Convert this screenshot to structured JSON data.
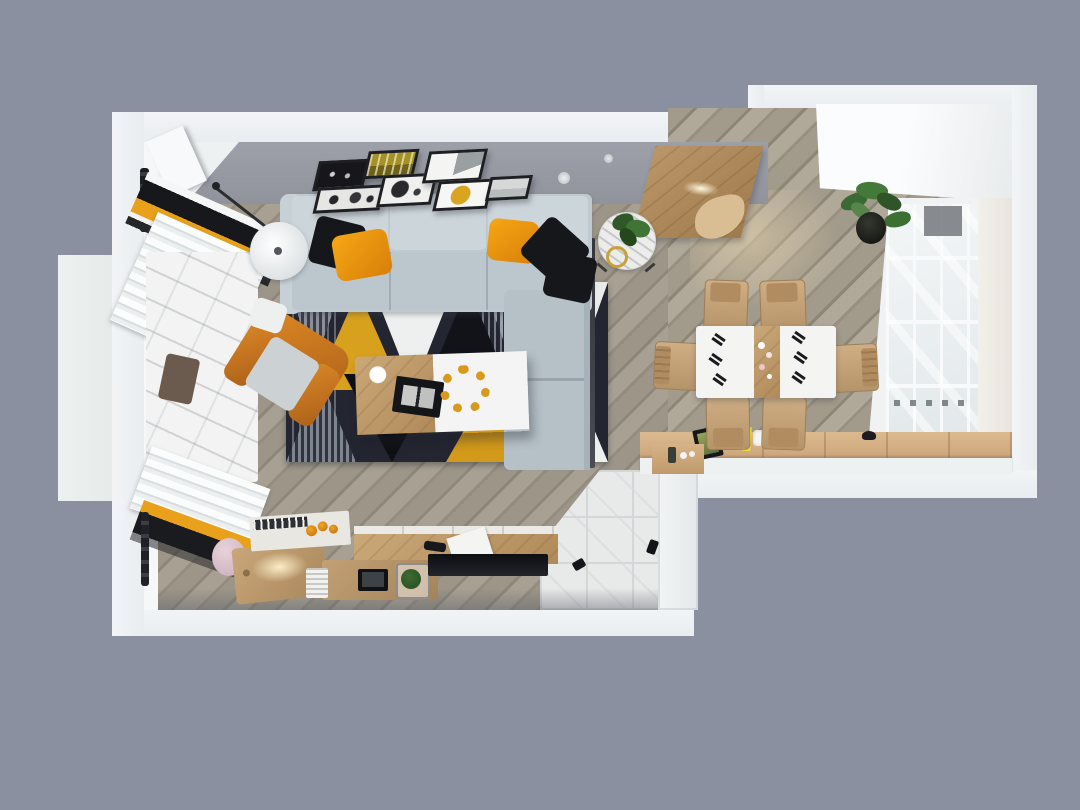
{
  "scene": {
    "type": "3d-floor-plan-top-view",
    "description": "Photorealistic top-down 3D render of a studio apartment: living room with L-shaped sofa and geometric rug, bedroom nook with curtains on the left, dining area with six chairs, kitchen corner with sink island, large gridded window on the right wall, gallery wall frames on the top wall.",
    "visible_text": "none"
  },
  "palette": {
    "bg": "#8a90a0",
    "wall": "#f2f4f6",
    "bump": "#e6ebe9",
    "ceiling-a": "#9da0a9",
    "ceiling-b": "#90939c",
    "floor-a": "#9d9688",
    "floor-b": "#8e8779",
    "floor-c": "#a8a193",
    "floor-d": "#948d7f",
    "tile": "#e8e9e9",
    "tile-line": "#d4d7d8",
    "rug": "#232530",
    "rug-yellow": "#d7a01d",
    "rug-white": "#eef0ef",
    "rug-gray": "#868b96",
    "sofa": "#bfc9d0",
    "sofa-light": "#ccd5da",
    "chaise": "#b6c0c7",
    "orange": "#ef9b10",
    "orange-dark": "#c97a17",
    "armchair": "#cd7a20",
    "wood": "#b18a5a",
    "wood-light": "#caa878",
    "tan": "#cfae84",
    "tan-dark": "#b6946a",
    "white": "#f4f5f4",
    "black": "#16171b",
    "glass-b": "#e1e7ea",
    "marble": "#ececea",
    "pink": "#d7bfc9",
    "balcony": "#d8c1b4",
    "plant": "#3f6d38",
    "plant-dark": "#2b4f24",
    "counter-top": "#d2ad83",
    "counter-face": "#eef1f2"
  },
  "objects": [
    {
      "name": "gallery-frames",
      "count": 7,
      "colors": [
        "#16161a",
        "#8e7d20",
        "#d9a41f",
        "#e8e8e8"
      ]
    },
    {
      "name": "sectional-sofa",
      "room": "living-room",
      "color": "#bfc9d0",
      "pillows": [
        "black",
        "orange",
        "orange",
        "black",
        "black"
      ]
    },
    {
      "name": "geometric-rug",
      "room": "living-room",
      "base": "#232530",
      "accents": [
        "#d7a01d",
        "#eef0ef",
        "#868b96"
      ]
    },
    {
      "name": "coffee-table",
      "materials": [
        "wood",
        "white"
      ],
      "items": [
        "cup",
        "open-book",
        "gold-wreath"
      ]
    },
    {
      "name": "orange-armchair",
      "color": "#cd7a20"
    },
    {
      "name": "floor-lamp-round-shade",
      "color": "#ffffff"
    },
    {
      "name": "bedroom-nook",
      "elements": [
        "door",
        "curtains",
        "black-yellow-stripe-band",
        "marble-bedding",
        "pink-ball-pouf"
      ]
    },
    {
      "name": "tv-console",
      "material": "wood",
      "items": [
        "tv",
        "remote",
        "paper",
        "books",
        "tablet",
        "plant-basket",
        "glow-chest"
      ]
    },
    {
      "name": "kitchen-corner",
      "elements": [
        "marble-tile-floor",
        "white-island",
        "black-faucet"
      ]
    },
    {
      "name": "dining-table",
      "top": "white-with-wood-runner",
      "place-settings": 6,
      "chairs": 6,
      "chair-color": "#cfae84"
    },
    {
      "name": "hanging-wood-cabinet",
      "feature": "under-light"
    },
    {
      "name": "round-marble-side-table",
      "item": "plant"
    },
    {
      "name": "potted-plant",
      "location": "near-window"
    },
    {
      "name": "window-grid",
      "location": "right-wall",
      "mullions": "white"
    },
    {
      "name": "balcony-strip",
      "color": "#d8c1b4",
      "items": [
        "small-plants"
      ]
    }
  ]
}
